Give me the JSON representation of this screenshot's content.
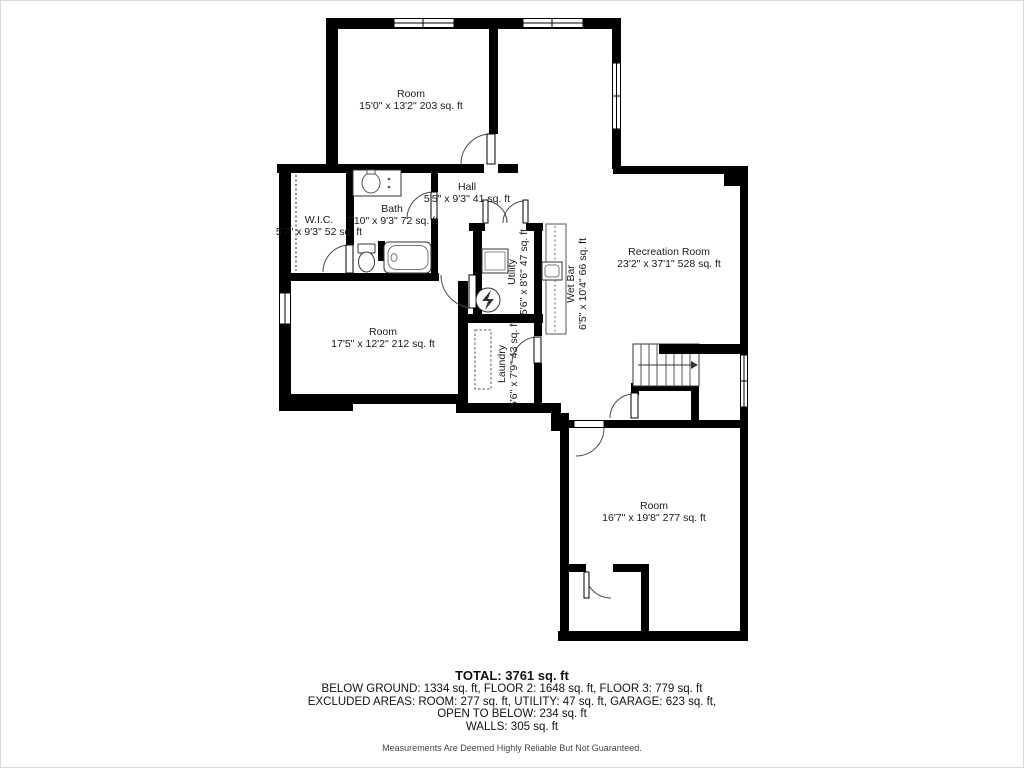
{
  "floorplan": {
    "rooms": [
      {
        "name": "Room",
        "dims": "15'0\" x 13'2\" 203 sq. ft"
      },
      {
        "name": "Hall",
        "dims": "5'5\" x 9'3\" 41 sq. ft"
      },
      {
        "name": "Bath",
        "dims": "7'10\" x 9'3\" 72 sq. ft"
      },
      {
        "name": "W.I.C.",
        "dims": "5'7\" x 9'3\" 52 sq. ft"
      },
      {
        "name": "Recreation Room",
        "dims": "23'2\" x 37'1\" 528 sq. ft"
      },
      {
        "name": "Utility",
        "dims": "5'6\" x 8'6\" 47 sq. ft"
      },
      {
        "name": "Wet Bar",
        "dims": "6'5\" x 10'4\" 66 sq. ft"
      },
      {
        "name": "Room",
        "dims": "17'5\" x 12'2\" 212 sq. ft"
      },
      {
        "name": "Laundry",
        "dims": "5'6\" x 7'9\" 43 sq. ft"
      },
      {
        "name": "Room",
        "dims": "16'7\" x 19'8\" 277 sq. ft"
      }
    ],
    "summary": {
      "total": "TOTAL: 3761 sq. ft",
      "floors": "BELOW GROUND: 1334 sq. ft, FLOOR 2: 1648 sq. ft, FLOOR 3: 779 sq. ft",
      "excluded": "EXCLUDED AREAS: ROOM: 277 sq. ft, UTILITY: 47 sq. ft, GARAGE: 623 sq. ft,",
      "open_to_below": "OPEN TO BELOW: 234 sq. ft",
      "walls": "WALLS: 305 sq. ft",
      "disclaimer": "Measurements Are Deemed Highly Reliable But Not Guaranteed."
    },
    "colors": {
      "wall": "#000000",
      "background": "#ffffff",
      "text": "#1a1a1a"
    }
  }
}
